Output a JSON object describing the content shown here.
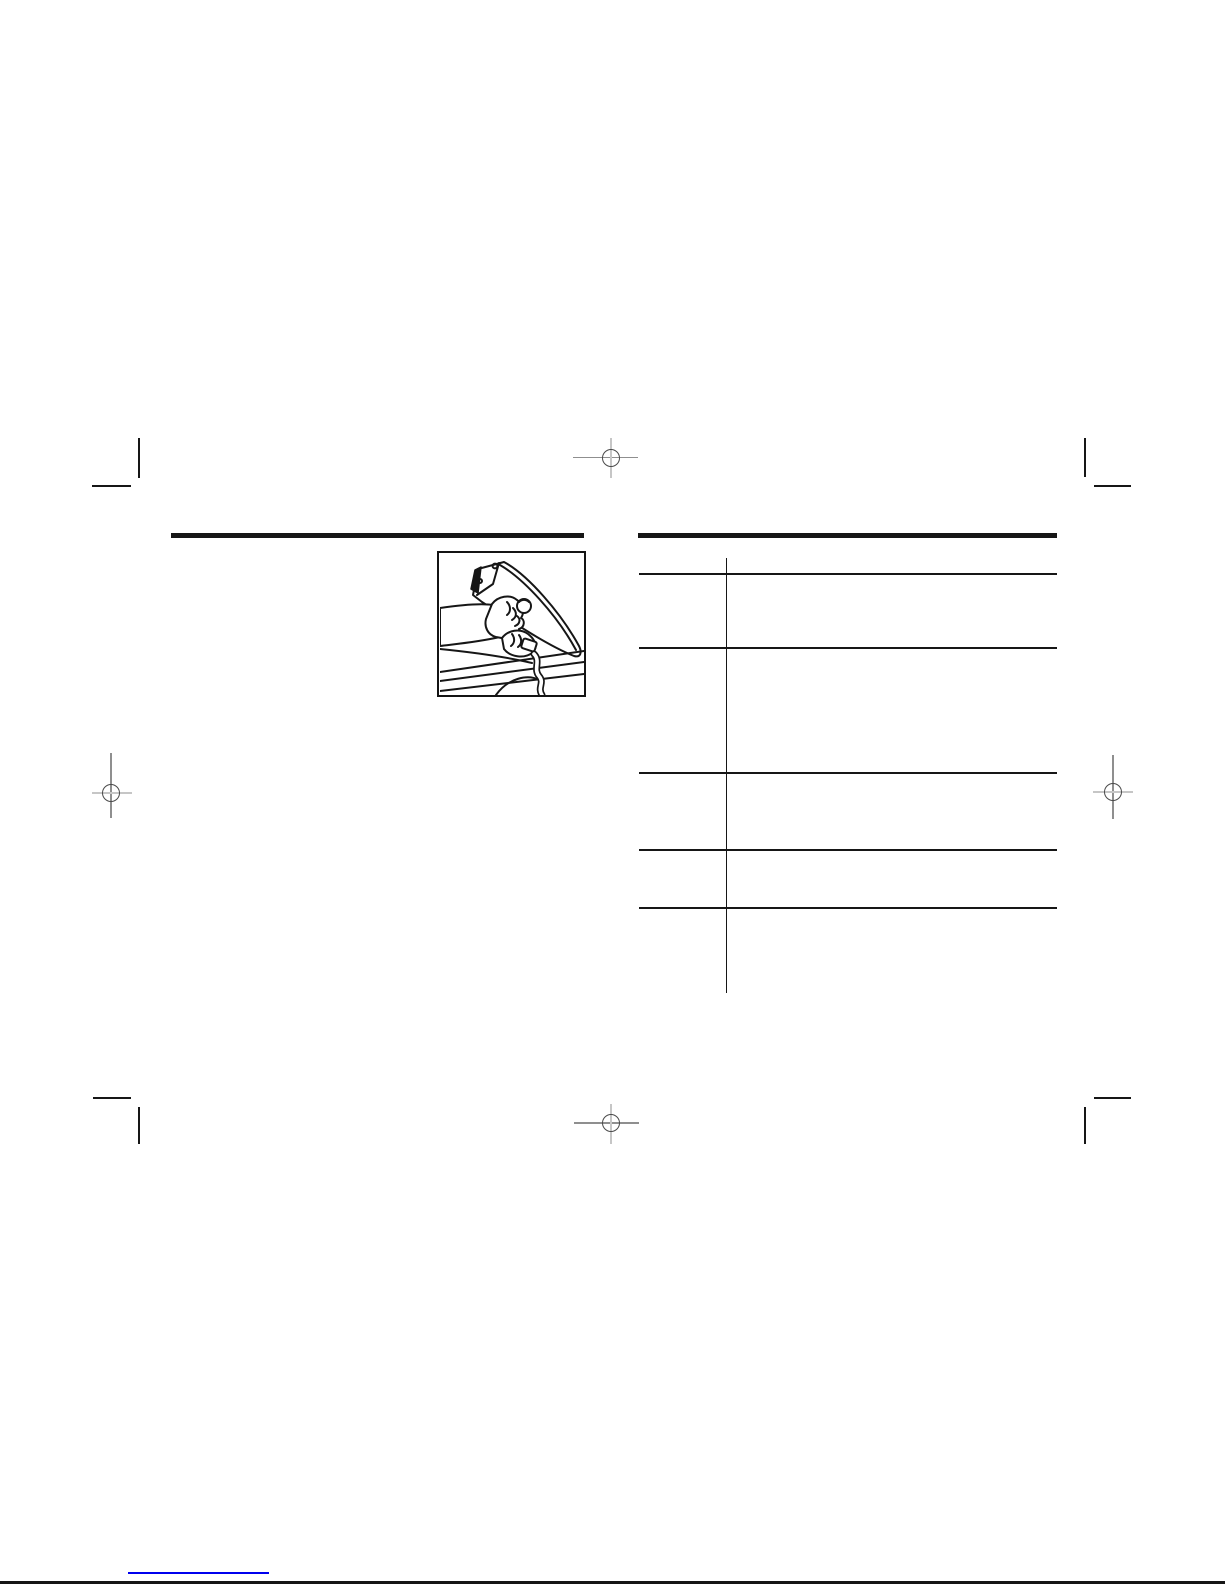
{
  "page": {
    "kind": "scanned-manual-page",
    "background_color": "#ffffff",
    "ink_color": "#161616"
  },
  "left_column": {
    "figure": {
      "name": "emptying-iron-illustration",
      "alt": "Hand gripping a clothes iron tilted over a sink edge to empty water from the tank"
    }
  },
  "right_column": {
    "table": {
      "row_dividers": 5,
      "column_dividers": 1,
      "visible_text": ""
    }
  },
  "print_marks": {
    "registration_positions": [
      "top-center",
      "middle-left",
      "middle-right",
      "bottom-center"
    ],
    "crop_corner_positions": [
      "top-left",
      "top-right",
      "bottom-left",
      "bottom-right"
    ],
    "dark_gray": "#8f8f8f",
    "light_gray": "#c6c6c6",
    "circle_gray": "#4a4a4a"
  },
  "footer": {
    "link_text": "",
    "link_underline_color": "#0000ee"
  }
}
